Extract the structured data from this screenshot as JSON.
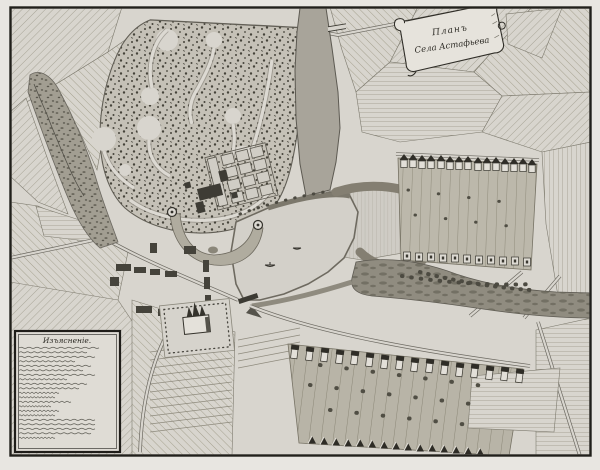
{
  "cartouche": {
    "line1": "Планъ",
    "line2": "Села Астафьева"
  },
  "legend": {
    "title": "Изъясненіе."
  },
  "colors": {
    "paper": "#d8d5ce",
    "margin": "#e8e6e1",
    "ink": "#2e2c26",
    "frame": "#21201b",
    "park": "#c5c1b7",
    "river_valley": "#908c80",
    "pond": "#d3d0c9",
    "village_strips": "#bcb8ab"
  }
}
